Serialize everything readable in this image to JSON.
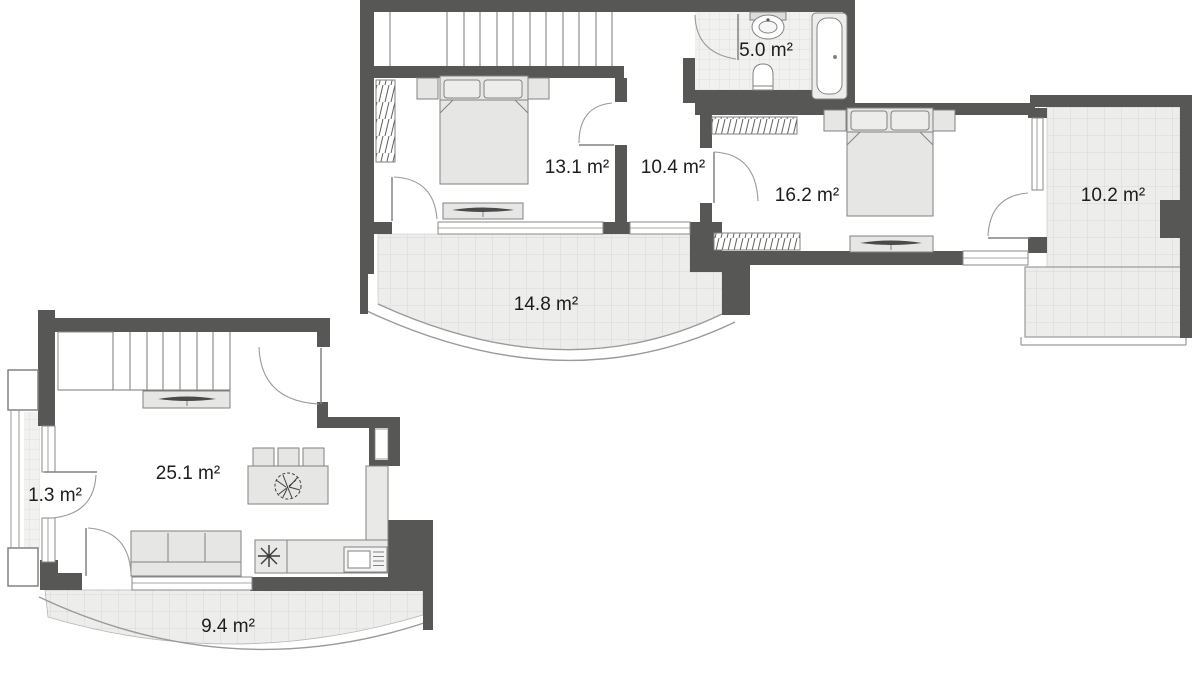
{
  "floorplan": {
    "upper_floor": {
      "rooms": [
        {
          "id": "bedroom-1",
          "area_label": "13.1 m²"
        },
        {
          "id": "hallway",
          "area_label": "10.4 m²"
        },
        {
          "id": "bathroom",
          "area_label": "5.0 m²"
        },
        {
          "id": "bedroom-2",
          "area_label": "16.2 m²"
        },
        {
          "id": "balcony-side",
          "area_label": "10.2 m²"
        },
        {
          "id": "balcony-front",
          "area_label": "14.8 m²"
        }
      ]
    },
    "lower_floor": {
      "rooms": [
        {
          "id": "living-room-kitchen",
          "area_label": "25.1 m²"
        },
        {
          "id": "loggia",
          "area_label": "1.3 m²"
        },
        {
          "id": "balcony",
          "area_label": "9.4 m²"
        }
      ]
    },
    "colors": {
      "wall": "#575756",
      "furniture_fill": "#e6e6e5",
      "tile_fill": "#ededec",
      "tile_line": "#d8d8d8",
      "label_text": "#1d1d1b"
    }
  }
}
